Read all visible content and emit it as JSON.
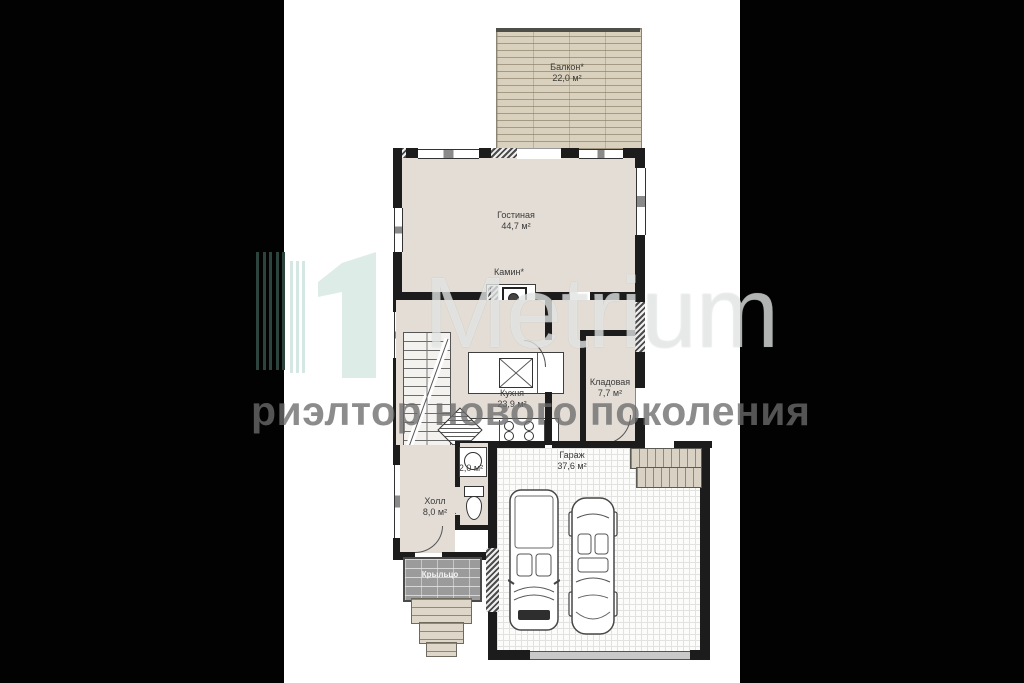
{
  "plan": {
    "rooms": [
      {
        "id": "balcony",
        "name": "Балкон*",
        "area": "22,0 м²"
      },
      {
        "id": "living-room",
        "name": "Гостиная",
        "area": "44,7 м²"
      },
      {
        "id": "fireplace",
        "name": "Камин*",
        "area": ""
      },
      {
        "id": "kitchen",
        "name": "Кухня",
        "area": "23,9 м²"
      },
      {
        "id": "pantry",
        "name": "Кладовая",
        "area": "7,7 м²"
      },
      {
        "id": "garage",
        "name": "Гараж",
        "area": "37,6 м²"
      },
      {
        "id": "wc",
        "name": "",
        "area": "2,0 м²"
      },
      {
        "id": "hall",
        "name": "Холл",
        "area": "8,0 м²"
      },
      {
        "id": "porch",
        "name": "Крыльцо",
        "area": ""
      }
    ],
    "colors": {
      "floor": "#e3ddd5",
      "deck": "#d9d0bd",
      "wall": "#1c1c1c",
      "porch_tiles": "#9b9b9b"
    }
  },
  "watermark": {
    "numeral": "1",
    "brand": "Metrium",
    "tagline": "риэлтор нового поколения",
    "colors": {
      "stripe_dark": "#2d433e",
      "stripe_light": "#d5e7e2",
      "numeral_fill": "#dcebe6",
      "tagline_gray": "#6c6c6c"
    }
  }
}
